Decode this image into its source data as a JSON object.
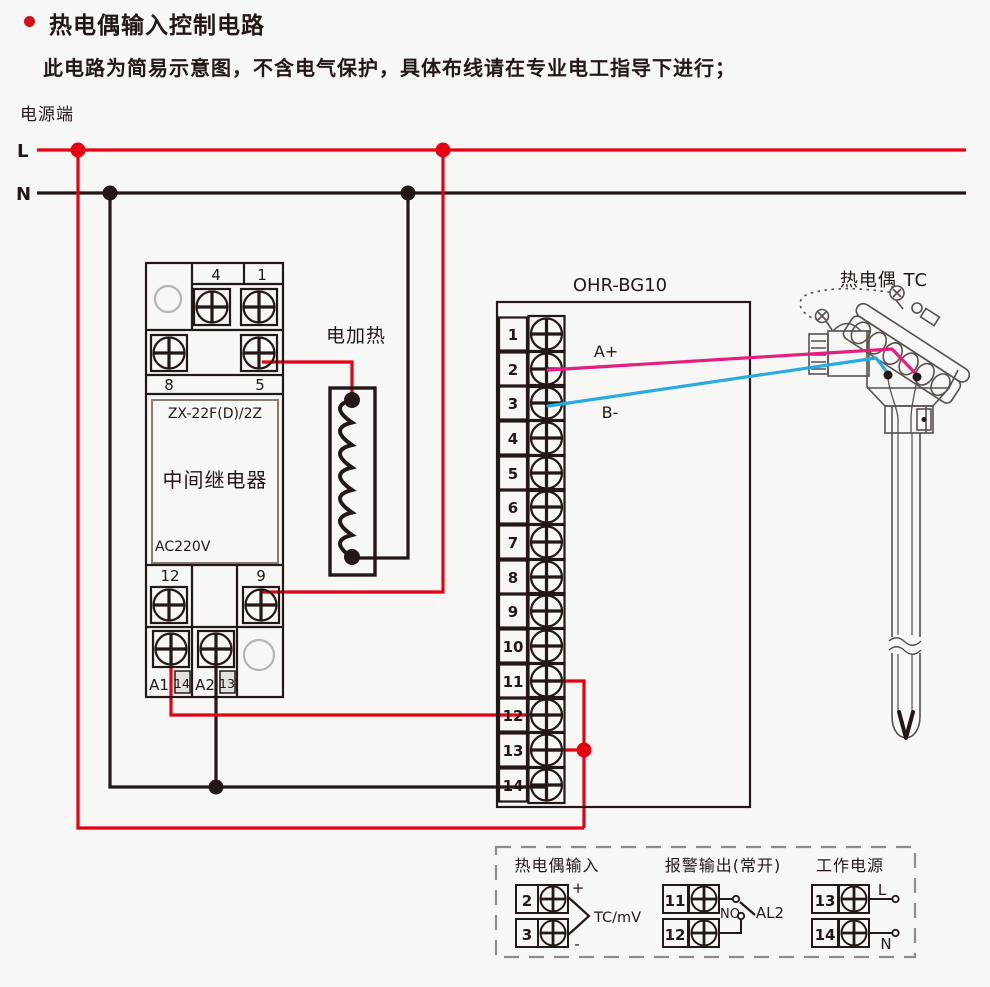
{
  "colors": {
    "accent_red": "#e60012",
    "line_dark": "#231815",
    "wire_magenta": "#e61e82",
    "wire_cyan": "#29abe2",
    "muted_gray": "#b5b5b5"
  },
  "header": {
    "title": "热电偶输入控制电路",
    "subtitle": "此电路为简易示意图，不含电气保护，具体布线请在专业电工指导下进行；"
  },
  "power": {
    "label": "电源端",
    "l": "L",
    "n": "N"
  },
  "relay": {
    "model": "ZX-22F(D)/2Z",
    "name": "中间继电器",
    "voltage": "AC220V",
    "terminals": {
      "t4": "4",
      "t1": "1",
      "t8": "8",
      "t5": "5",
      "t12": "12",
      "t9": "9",
      "a1": "A1",
      "t14": "14",
      "a2": "A2",
      "t13": "13"
    }
  },
  "heater": {
    "label": "电加热"
  },
  "controller": {
    "model": "OHR-BG10",
    "terminals": [
      "1",
      "2",
      "3",
      "4",
      "5",
      "6",
      "7",
      "8",
      "9",
      "10",
      "11",
      "12",
      "13",
      "14"
    ],
    "wire_a_label": "A+",
    "wire_b_label": "B-"
  },
  "thermocouple": {
    "label": "热电偶 TC"
  },
  "legend": {
    "tc_input": {
      "title": "热电偶输入",
      "t2": "2",
      "t3": "3",
      "plus": "+",
      "minus": "-",
      "signal": "TC/mV"
    },
    "alarm": {
      "title": "报警输出(常开)",
      "t11": "11",
      "t12": "12",
      "contact": "NO",
      "name": "AL2"
    },
    "power": {
      "title": "工作电源",
      "t13": "13",
      "t14": "14",
      "l": "L",
      "n": "N"
    }
  }
}
